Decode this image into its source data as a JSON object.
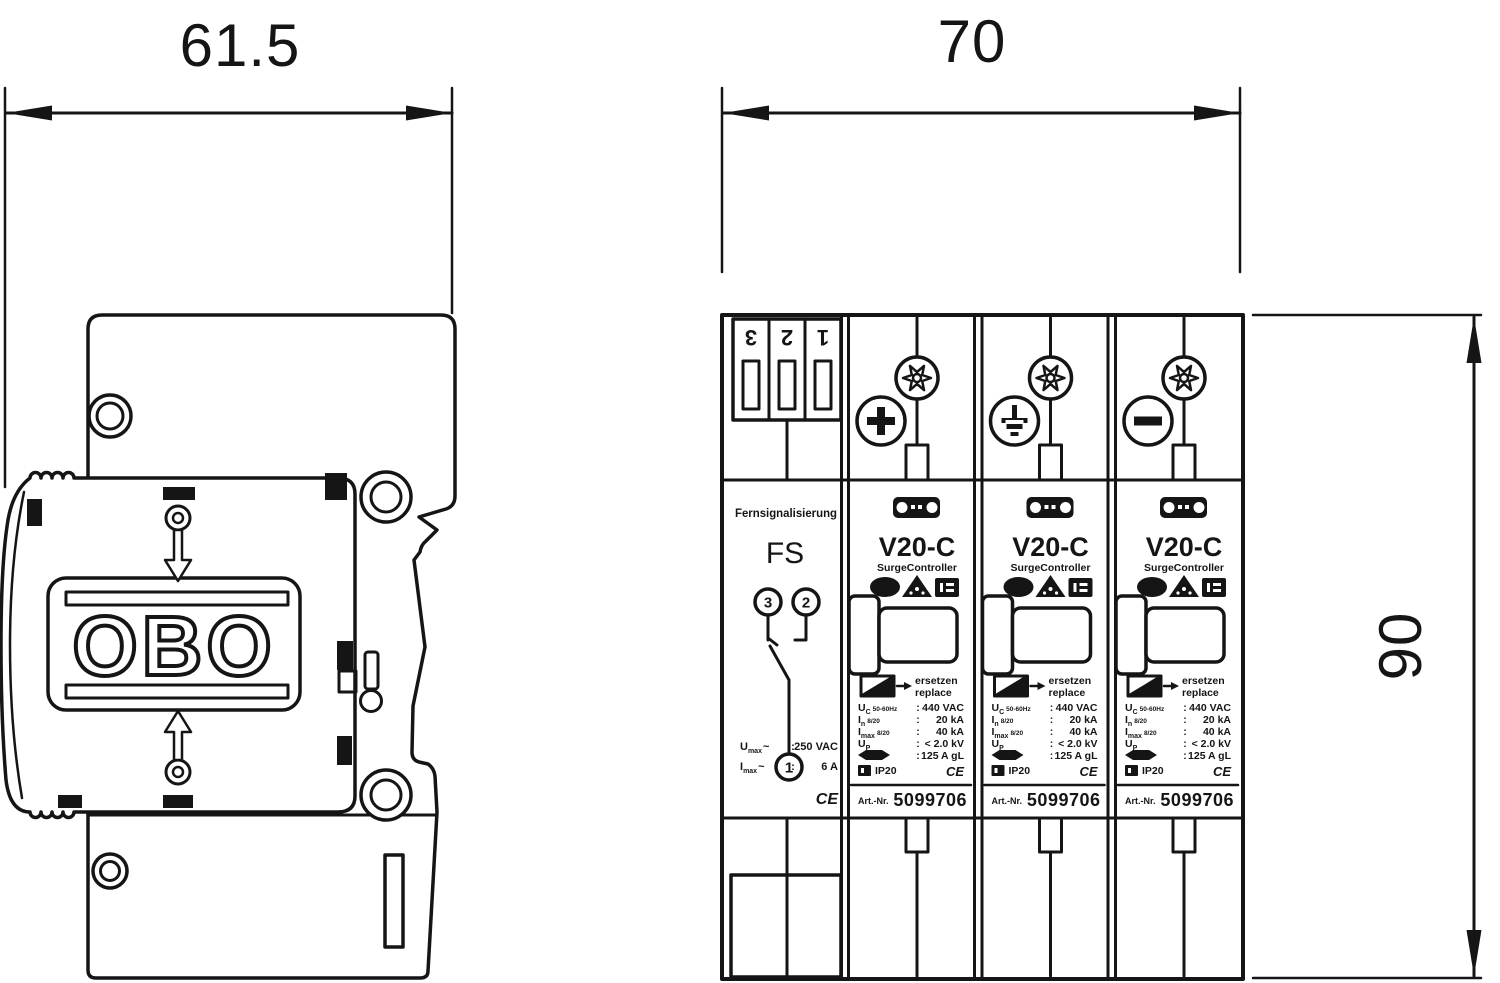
{
  "drawing": {
    "type": "technical-dimension-drawing",
    "separator": ":",
    "dimensions": {
      "side_width_mm": "61.5",
      "front_width_mm": "70",
      "front_height_mm": "90"
    },
    "side_view": {
      "logo": "OBO"
    },
    "front_view": {
      "fs": {
        "terminals": [
          "3",
          "2",
          "1"
        ],
        "title": "Fernsignalisierung",
        "name": "FS",
        "contact_top_left": "3",
        "contact_top_right": "2",
        "contact_common": "1",
        "specs": [
          {
            "sym": "U",
            "sub": "max",
            "suffix": "~",
            "value": "250 VAC"
          },
          {
            "sym": "I",
            "sub": "max",
            "suffix": "~",
            "value": "6 A"
          }
        ],
        "ce": "CE"
      },
      "v20": {
        "model": "V20-C",
        "subtitle": "SurgeController",
        "replace_de": "ersetzen",
        "replace_en": "replace",
        "specs": [
          {
            "sym": "U",
            "sub": "C",
            "cond": "50-60Hz",
            "value": "440 VAC"
          },
          {
            "sym": "I",
            "sub": "n",
            "cond": "8/20",
            "value": "20 kA"
          },
          {
            "sym": "I",
            "sub": "max",
            "cond": "8/20",
            "value": "40 kA"
          },
          {
            "sym": "U",
            "sub": "P",
            "cond": "",
            "value": "< 2.0 kV"
          },
          {
            "sym": "",
            "sub": "",
            "cond": "",
            "value": "125 A gL"
          }
        ],
        "ip_rating": "IP20",
        "ce": "CE",
        "art_label": "Art.-Nr.",
        "art_no": "5099706",
        "phase_symbols": [
          "plus",
          "earth",
          "minus"
        ]
      }
    },
    "icon_names": [
      "torx-screw-icon",
      "plus-terminal-icon",
      "earth-terminal-icon",
      "minus-terminal-icon",
      "obo-badge-icon",
      "kema-oval-icon",
      "vde-triangle-icon",
      "approval-box-icon",
      "varistor-replace-icon",
      "arrow-right-icon",
      "fuse-icon",
      "ip-box-icon",
      "down-arrow-icon",
      "up-arrow-icon",
      "dimension-arrow-icon"
    ]
  }
}
